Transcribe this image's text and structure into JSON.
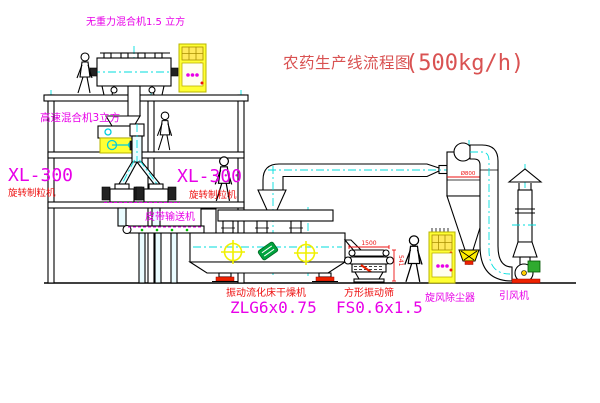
{
  "title": {
    "main": "农药生产线流程图",
    "capacity": "(500kg/h)"
  },
  "labels": {
    "gravity_free_mixer": "无重力混合机1.5 立方",
    "high_speed_mixer": "高速混合机3立方",
    "granulator_left_model": "XL-300",
    "granulator_left_name": "旋转制粒机",
    "granulator_right_model": "XL-300",
    "granulator_right_name": "旋转制粒机",
    "belt_conveyor": "皮带输送机",
    "dryer_name": "振动流化床干燥机",
    "dryer_model": "ZLG6x0.75",
    "sieve_name": "方形振动筛",
    "sieve_model": "FS0.6x1.5",
    "cyclone": "旋风除尘器",
    "fan": "引风机"
  },
  "dimensions": {
    "sieve_width": "1500",
    "sieve_height": "541",
    "cyclone_diameter": "Ø800"
  },
  "colors": {
    "label_magenta": "#e800e8",
    "label_red": "#ee1111",
    "title_red": "#d95252",
    "centerline_cyan": "#00dede",
    "equipment_yellow": "#ffff33",
    "motor_green": "#2faa2f",
    "alert_red": "#ee2200",
    "line_black": "#000000"
  }
}
